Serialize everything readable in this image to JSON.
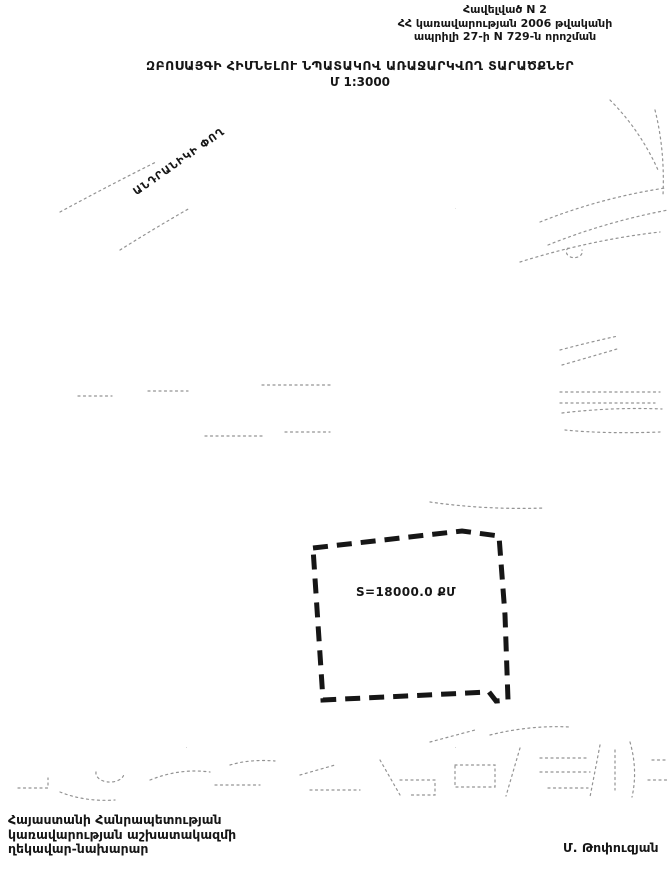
{
  "header": {
    "appendix_line1": "Հավելված N 2",
    "appendix_line2": "ՀՀ կառավարության 2006 թվականի",
    "appendix_line3": "ապրիլի 27-ի N 729-ն որոշման"
  },
  "title": {
    "main": "ԶԲՈՍԱՅԳԻ ՀԻՄՆԵԼՈՒ ՆՊԱՏԱԿՈՎ ԱՌԱՋԱՐԿՎՈՂ ՏԱՐԱԾՔՆԵՐ",
    "scale": "Մ 1:3000"
  },
  "map": {
    "street_label": "ԱՆԴՐԱՆԻԿԻ ՓՈՂ",
    "parcel": {
      "area_label": "S=18000.0 ՔՄ"
    }
  },
  "footer": {
    "signature_block": [
      "Հայաստանի Հանրապետության",
      "կառավարության աշխատակազմի",
      "ղեկավար-նախարար"
    ],
    "signatory": "Մ. Թոփուզյան"
  },
  "colors": {
    "paper": "#ffffff",
    "ink": "#161616",
    "speckle": "#333333"
  }
}
